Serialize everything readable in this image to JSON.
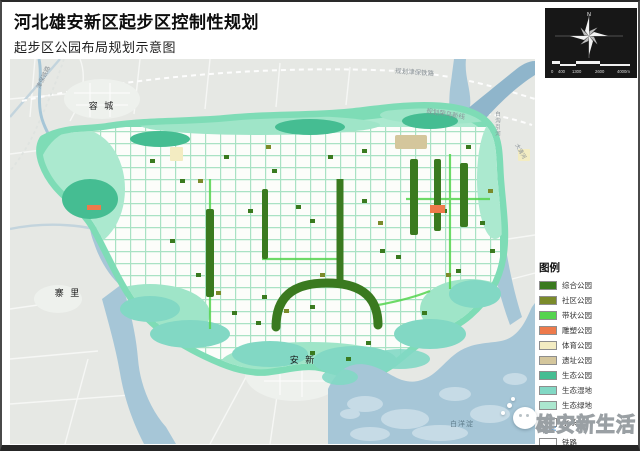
{
  "title": {
    "main": "河北雄安新区起步区控制性规划",
    "sub": "起步区公园布局规划示意图"
  },
  "compass": {
    "north_label": "N",
    "scale_ticks": [
      "0",
      "400",
      "1300",
      "2600",
      "4000m"
    ]
  },
  "map": {
    "labels": {
      "rongcheng": "容 城",
      "zhaili": "寨 里",
      "anxin": "安 新",
      "baiyangdian": "白洋淀",
      "rail_planned": "规划津保铁路",
      "rongwu_line": "规划荣乌新线",
      "rail_nw": "津保铁路",
      "river_right": "白沟引河",
      "river_ne": "大清河"
    }
  },
  "legend": {
    "title": "图例",
    "items": [
      {
        "key": "zonghe",
        "label": "综合公园",
        "color": "#3a7a1f",
        "type": "fill"
      },
      {
        "key": "shequ",
        "label": "社区公园",
        "color": "#7b8b2a",
        "type": "fill"
      },
      {
        "key": "daizhuang",
        "label": "带状公园",
        "color": "#55d44e",
        "type": "fill"
      },
      {
        "key": "diaosu",
        "label": "雕塑公园",
        "color": "#ee7a4b",
        "type": "fill"
      },
      {
        "key": "tiyu",
        "label": "体育公园",
        "color": "#f3ecc2",
        "type": "fill"
      },
      {
        "key": "yizhi",
        "label": "遗址公园",
        "color": "#d4c69c",
        "type": "fill"
      },
      {
        "key": "stgy",
        "label": "生态公园",
        "color": "#45bd92",
        "type": "fill"
      },
      {
        "key": "stsd",
        "label": "生态湿地",
        "color": "#82d8c4",
        "type": "fill"
      },
      {
        "key": "stld",
        "label": "生态绿地",
        "color": "#abe7cf",
        "type": "fill"
      },
      {
        "key": "shuixi",
        "label": "水系",
        "color": "#5b9bd5",
        "type": "water"
      },
      {
        "key": "tielu",
        "label": "铁路",
        "color": "#222222",
        "type": "rail"
      }
    ]
  },
  "watermark": {
    "text": "雄安新生活"
  }
}
